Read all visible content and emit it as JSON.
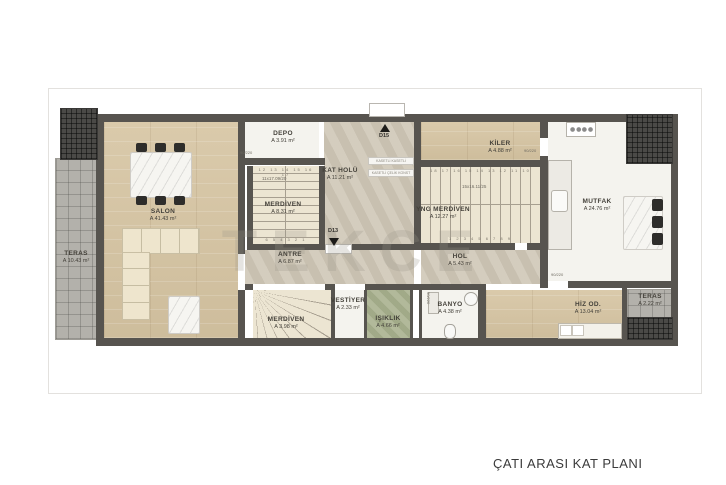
{
  "page": {
    "footer_title": "ÇATI ARASI KAT PLANI",
    "watermark": "TEKCE"
  },
  "colors": {
    "wall": "#57544f",
    "wood_floor": "#d6c6a7",
    "stone_floor": "#cfc7b7",
    "terrace_tile": "#b3b1ab",
    "roof_hatch": "#4b4a47",
    "lightwell_green": "#a9b18f",
    "label_text": "#44413a"
  },
  "rooms": [
    {
      "name": "TERAS",
      "area": "A 10.43 m²"
    },
    {
      "name": "SALON",
      "area": "A 41.43 m²"
    },
    {
      "name": "DEPO",
      "area": "A 3.91 m²"
    },
    {
      "name": "MERDİVEN",
      "area": "A 8.31 m²"
    },
    {
      "name": "KAT HOLÜ",
      "area": "A 11.21 m²"
    },
    {
      "name": "ANTRE",
      "area": "A 6.87 m²"
    },
    {
      "name": "YNG MERDİVEN",
      "area": "A 12.27 m²"
    },
    {
      "name": "HOL",
      "area": "A 5.43 m²"
    },
    {
      "name": "KİLER",
      "area": "A 4.88 m²"
    },
    {
      "name": "MUTFAK",
      "area": "A 24.76 m²"
    },
    {
      "name": "VESTİYER",
      "area": "A 2.33 m²"
    },
    {
      "name": "IŞIKLIK",
      "area": "A 4.66 m²"
    },
    {
      "name": "BANYO",
      "area": "A 4.38 m²"
    },
    {
      "name": "MERDİVEN",
      "area": "A 3.98 m²"
    },
    {
      "name": "HİZ OD.",
      "area": "A 13.04 m²"
    },
    {
      "name": "TERAS",
      "area": "A 2.22 m²"
    }
  ],
  "markers": {
    "d15": "D15",
    "d13": "D13"
  },
  "annotations": {
    "door_label": "90/220",
    "stair_note_main": "11x17.09/20",
    "stair_note_fire": "15x16.11/25",
    "steps_main_top": "12 13 14 15 16 17",
    "steps_main_bottom": "6 5 4 3 2 1",
    "steps_fire_top": "18 17 16 15 14 13 12 11 10",
    "steps_fire_bottom": "1 2 3 4 5 6 7 8 9",
    "construction_note_1": "KASETLİ KASETLİ",
    "construction_note_2": "KASETLİ ÇELİK KONST"
  }
}
